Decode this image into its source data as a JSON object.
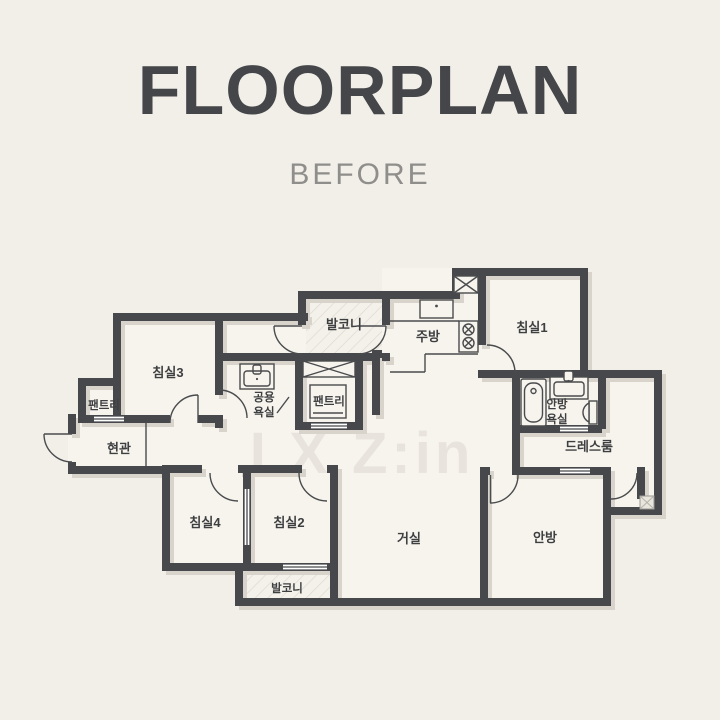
{
  "title": "FLOORPLAN",
  "subtitle": "BEFORE",
  "watermark": "LX Z:in",
  "colors": {
    "background": "#f2efe9",
    "wall": "#47484b",
    "floor": "#f7f4ee",
    "wall_shadow": "#d8d4cc",
    "hatch": "#dcd8d1",
    "label": "#3e3f41",
    "title": "#45464a",
    "subtitle": "#8f8e8a",
    "watermark": "#e8e4dd"
  },
  "floorplan": {
    "rooms": [
      {
        "name": "balcony-top",
        "label": "발코니"
      },
      {
        "name": "kitchen",
        "label": "주방"
      },
      {
        "name": "bedroom-1",
        "label": "침실1"
      },
      {
        "name": "bedroom-3",
        "label": "침실3"
      },
      {
        "name": "pantry-left",
        "label": "팬트리"
      },
      {
        "name": "common-bathroom",
        "label_line1": "공용",
        "label_line2": "욕실"
      },
      {
        "name": "pantry-center",
        "label": "팬트리"
      },
      {
        "name": "master-bathroom",
        "label_line1": "안방",
        "label_line2": "욕실"
      },
      {
        "name": "entrance",
        "label": "현관"
      },
      {
        "name": "dressroom",
        "label": "드레스룸"
      },
      {
        "name": "bedroom-4",
        "label": "침실4"
      },
      {
        "name": "bedroom-2",
        "label": "침실2"
      },
      {
        "name": "living-room",
        "label": "거실"
      },
      {
        "name": "master-bedroom",
        "label": "안방"
      },
      {
        "name": "balcony-bottom",
        "label": "발코니"
      }
    ],
    "fixtures": [
      "kitchen-sink-icon",
      "stove-burner-icon",
      "washbasin-icon",
      "bathtub-icon",
      "toilet-icon",
      "wardrobe-icon",
      "sliding-door-icon",
      "door-swing-icon",
      "duct-box-icon"
    ]
  }
}
